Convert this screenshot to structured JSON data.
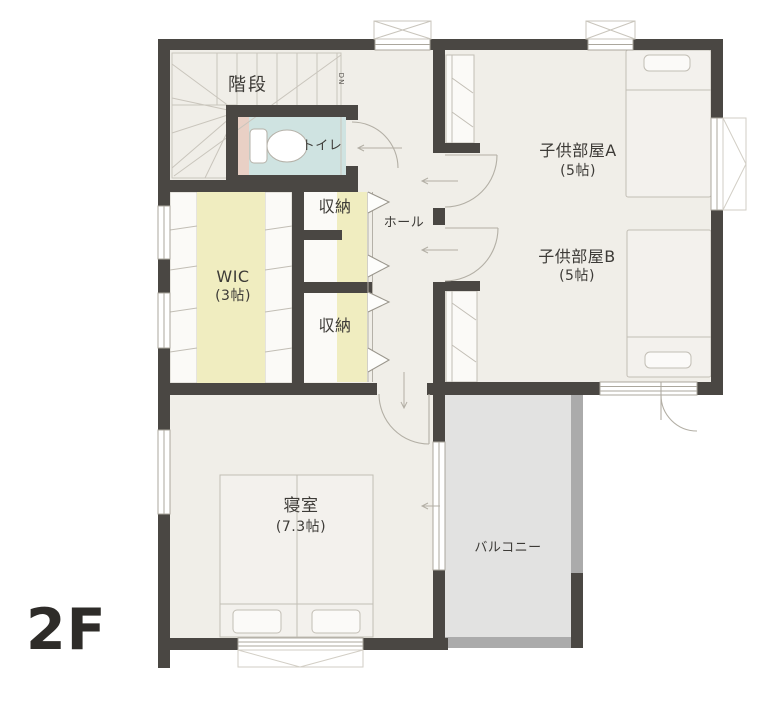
{
  "floor_plan": {
    "floor_label": "2F",
    "rooms": {
      "stairs": {
        "label": "階段"
      },
      "toilet": {
        "label": "トイレ"
      },
      "storage_top": {
        "label": "収納"
      },
      "storage_bottom": {
        "label": "収納"
      },
      "wic": {
        "label": "WIC",
        "size": "(3帖)"
      },
      "hall": {
        "label": "ホール"
      },
      "kids_room_a": {
        "label": "子供部屋A",
        "size": "(5帖)"
      },
      "kids_room_b": {
        "label": "子供部屋B",
        "size": "(5帖)"
      },
      "bedroom": {
        "label": "寝室",
        "size": "(7.3帖)"
      },
      "balcony": {
        "label": "バルコニー"
      }
    },
    "annotations": {
      "stairs_direction": "DN"
    },
    "colors": {
      "wall": "#4a4743",
      "floor": "#f0eee8",
      "closet_floor": "#f0edc0",
      "toilet_floor": "#cfe3e1",
      "toilet_accent": "#e9d0c5",
      "balcony_floor": "#e2e2e1",
      "balcony_rail": "#ababab"
    }
  }
}
